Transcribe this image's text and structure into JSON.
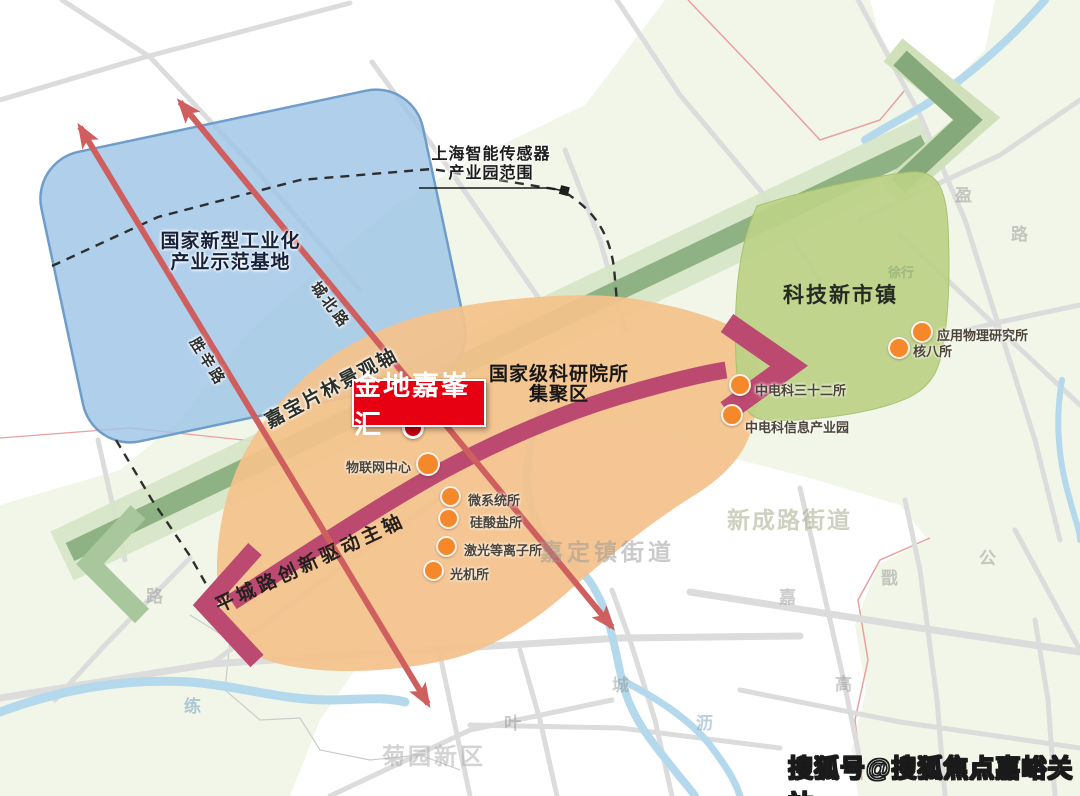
{
  "map": {
    "titles": {
      "industrial_base_line1": "国家新型工业化",
      "industrial_base_line2": "产业示范基地",
      "sensor_park_line1": "上海智能传感器",
      "sensor_park_line2": "产业园范围",
      "research_cluster_line1": "国家级科研院所",
      "research_cluster_line2": "集聚区",
      "tech_town": "科技新市镇"
    },
    "axes": {
      "landscape_axis": "嘉宝片林景观轴",
      "innovation_axis": "平城路创新驱动主轴"
    },
    "project_marker": {
      "label": "金地嘉峯汇"
    },
    "roads": {
      "shengxin": "胜辛路",
      "chengbei": "城北路"
    },
    "pois": [
      {
        "label": "物联网中心"
      },
      {
        "label": "微系统所"
      },
      {
        "label": "硅酸盐所"
      },
      {
        "label": "激光等离子所"
      },
      {
        "label": "光机所"
      },
      {
        "label": "中电科三十二所"
      },
      {
        "label": "中电科信息产业园"
      },
      {
        "label": "核八所"
      },
      {
        "label": "应用物理研究所"
      }
    ],
    "districts": [
      {
        "label": "嘉定镇街道"
      },
      {
        "label": "新成路街道"
      },
      {
        "label": "菊园新区"
      }
    ],
    "base_labels": [
      "路",
      "练",
      "叶",
      "城",
      "沥",
      "嘉",
      "戬",
      "公",
      "高",
      "路",
      "盈",
      "徐行"
    ],
    "colors": {
      "project_red": "#e60012",
      "axis_crimson": "#bc4a70",
      "band_green": "#8fb284",
      "zone_blue": "#9ec4e6",
      "zone_orange": "#f4c28b",
      "zone_green": "#bcd287",
      "poi_orange": "#f5882b",
      "road_red": "#cf5f5f"
    }
  },
  "watermark": {
    "text": "搜狐号@搜狐焦点嘉峪关站"
  }
}
